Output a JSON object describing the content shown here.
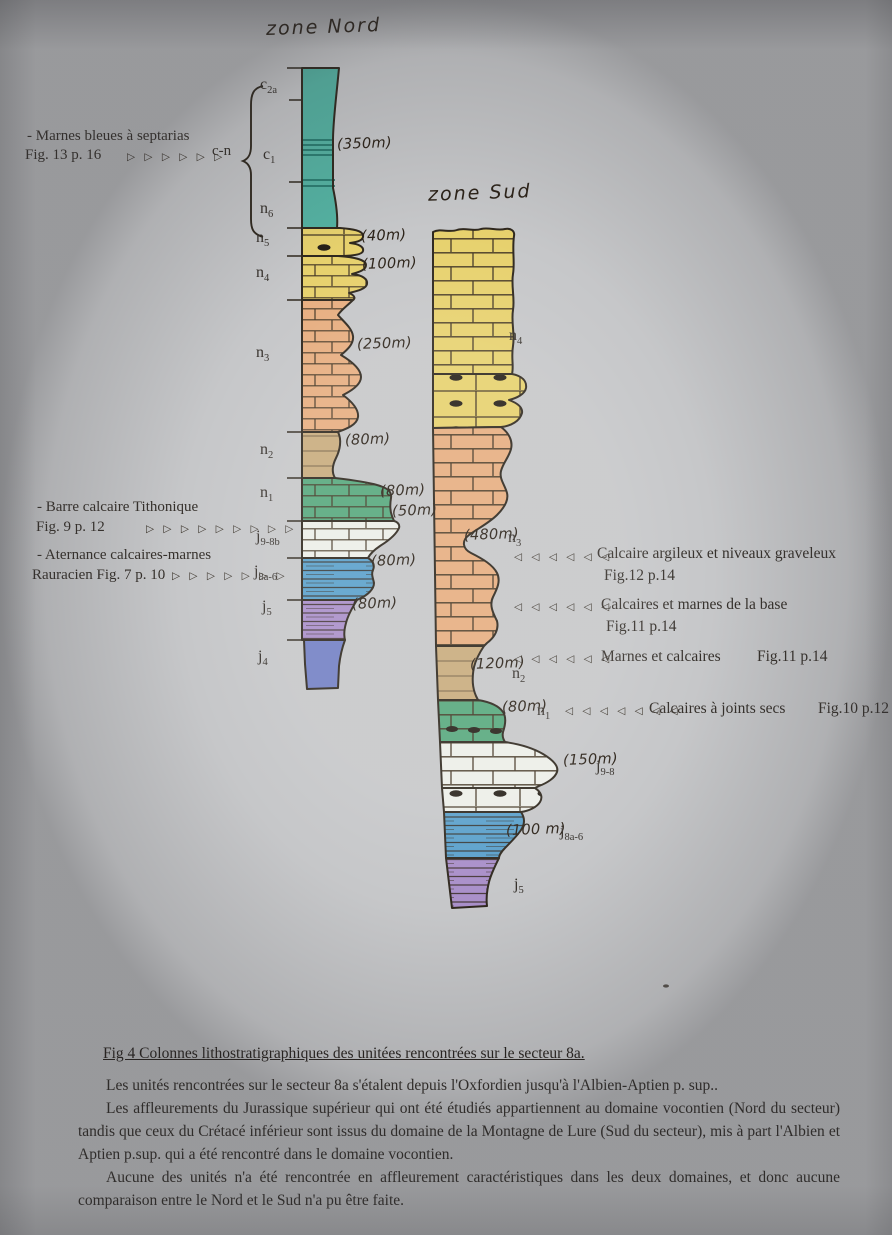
{
  "titles": {
    "nord": "zone Nord",
    "sud": "zone Sud"
  },
  "colors": {
    "teal": "#54b2a2",
    "yellow": "#e7d16d",
    "salmon": "#e7ae80",
    "tan": "#c9ab7d",
    "green": "#57a87d",
    "white_unit": "#eceee8",
    "blue": "#5aa0cb",
    "purple": "#a98fc9",
    "indigo": "#7380c4",
    "paper": "#c6c7c9",
    "ink": "#2f281e"
  },
  "nord": {
    "group_label": "c-n",
    "group_thickness": "(350m)",
    "units": [
      {
        "main": "c",
        "sub": "2a"
      },
      {
        "main": "c",
        "sub": "1"
      },
      {
        "main": "n",
        "sub": "6"
      },
      {
        "main": "n",
        "sub": "5",
        "thickness": "(40m)"
      },
      {
        "main": "n",
        "sub": "4",
        "thickness": "(100m)"
      },
      {
        "main": "n",
        "sub": "3",
        "thickness": "(250m)"
      },
      {
        "main": "n",
        "sub": "2",
        "thickness": "(80m)"
      },
      {
        "main": "n",
        "sub": "1",
        "thickness": "(80m)"
      },
      {
        "main": "j",
        "sub": "9-8b",
        "thickness": "(50m)"
      },
      {
        "main": "j",
        "sub": "8a-6",
        "thickness": "(80m)"
      },
      {
        "main": "j",
        "sub": "5",
        "thickness": "(80m)"
      },
      {
        "main": "j",
        "sub": "4"
      }
    ]
  },
  "sud": {
    "units": [
      {
        "main": "n",
        "sub": "4"
      },
      {
        "main": "n",
        "sub": "3",
        "thickness": "(480m)"
      },
      {
        "main": "n",
        "sub": "2",
        "thickness": "(120m)"
      },
      {
        "main": "n",
        "sub": "1",
        "thickness": "(80m)"
      },
      {
        "main": "j",
        "sub": "9-8",
        "thickness": "(150m)"
      },
      {
        "main": "j",
        "sub": "8a-6",
        "thickness": "(100 m)"
      },
      {
        "main": "j",
        "sub": "5"
      }
    ]
  },
  "annotations_left": [
    {
      "line1": "- Marnes bleues à septarias",
      "line2": "Fig. 13 p. 16",
      "arrows": "▷ ▷ ▷ ▷ ▷ ▷",
      "target": "c-n"
    },
    {
      "line1": "- Barre calcaire Tithonique",
      "line2": "Fig. 9 p. 12",
      "arrows": "▷ ▷ ▷ ▷ ▷ ▷ ▷ ▷ ▷"
    },
    {
      "line1": "- Aternance calcaires-marnes",
      "line2": "Rauracien Fig. 7 p. 10",
      "arrows": "▷ ▷ ▷ ▷ ▷ ▷ ▷"
    }
  ],
  "annotations_right": [
    {
      "arrows": "◁ ◁ ◁ ◁ ◁ ◁",
      "text": "Calcaire argileux et niveaux graveleux",
      "fig": "Fig.12 p.14"
    },
    {
      "arrows": "◁ ◁ ◁ ◁ ◁ ◁",
      "text": "Calcaires et marnes de la base",
      "fig": "Fig.11 p.14"
    },
    {
      "arrows": "◁ ◁ ◁ ◁ ◁ ◁",
      "text": "Marnes et calcaires",
      "fig": "Fig.11 p.14"
    },
    {
      "arrows": "◁ ◁ ◁ ◁ ◁ ◁ ◁",
      "text": "Calcaires à joints secs",
      "fig": "Fig.10 p.12"
    }
  ],
  "caption": "Fig 4 Colonnes lithostratigraphiques des unitées rencontrées sur le secteur 8a.",
  "paragraphs": [
    "Les unités rencontrées sur le secteur 8a s'étalent depuis l'Oxfordien jusqu'à l'Albien-Aptien p. sup..",
    "Les affleurements du Jurassique supérieur qui ont été étudiés appartiennent au domaine vocontien (Nord du secteur) tandis que ceux du Crétacé inférieur sont issus du domaine de la Montagne de Lure (Sud du secteur), mis à part l'Albien et Aptien p.sup. qui a été rencontré dans le domaine vocontien.",
    "Aucune des unités n'a été rencontrée en affleurement caractéristiques dans les deux domaines, et donc aucune comparaison entre le Nord et le Sud n'a pu être faite."
  ]
}
